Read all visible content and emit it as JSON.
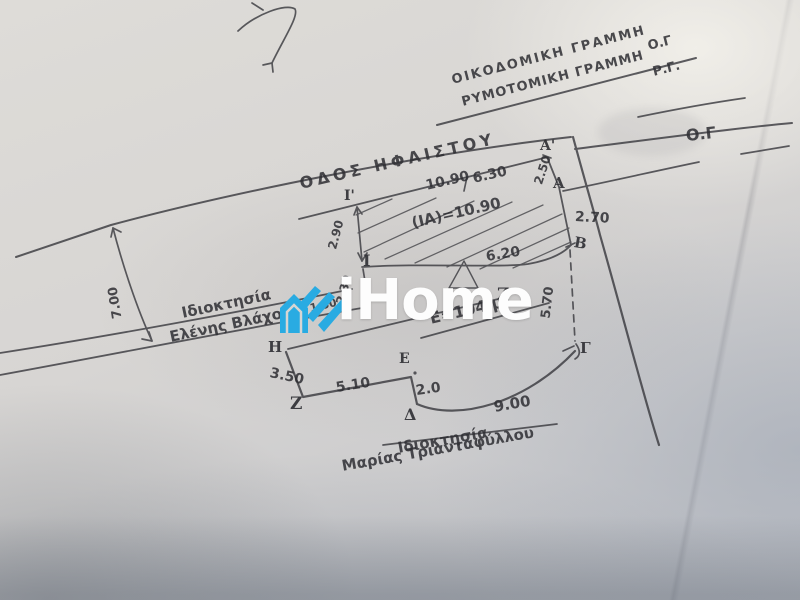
{
  "document_type": "hand-drawn survey site plan photo",
  "street": {
    "name": "ΟΔΟΣ ΗΦΑΙΣΤΟΥ"
  },
  "boundary_lines": {
    "building_line_label": "ΟΙΚΟΔΟΜΙΚΗ ΓΡΑΜΜΗ",
    "building_line_abbr": "Ο.Γ",
    "street_plan_line_label": "ΡΥΜΟΤΟΜΙΚΗ ΓΡΑΜΜΗ",
    "street_plan_line_abbr": "Ρ.Γ.",
    "right_abbr": "Ο.Γ"
  },
  "owners": {
    "left_title": "Ιδιοκτησία",
    "left_name": "Ελένης Βλάχου",
    "bottom_title": "Ιδιοκτησία",
    "bottom_name": "Μαρίας Τριανταφύλλου"
  },
  "points": {
    "a_prime": "Α'",
    "a": "Α",
    "b": "Β",
    "gamma": "Γ",
    "delta": "Δ",
    "epsilon": "Ε",
    "zeta_bottom": "Ζ",
    "zeta_mid": "Ζ",
    "eta": "Η",
    "iota_prime": "Ι'",
    "iota": "Ι"
  },
  "measurements": {
    "frontage_left": "10.90",
    "frontage_right": "6.30",
    "a_prime_to_a": "2.50",
    "a_to_b": "2.70",
    "ia_strip": "(ΙΑ)=10.90",
    "strip_bottom": "6.20",
    "i_prime_to_i": "2.90",
    "i_to_line": "2.30",
    "road_width": "7.00",
    "b_to_gamma": "5.70",
    "eta_to_zeta": "3.50",
    "zeta_to_corner": "5.10",
    "epsilon_to_delta": "2.0",
    "delta_to_gamma": "9.00",
    "eta_segment": "1.50",
    "area": "Ε=104 μ²"
  },
  "watermark": {
    "brand": "iHome",
    "icon": "house-logo-icon",
    "accent_color": "#29abe2",
    "text_color": "#fdfdfd"
  },
  "colors": {
    "ink": "#3b3b40",
    "paper": "#d6d4d2",
    "logo_blue": "#29abe2"
  }
}
